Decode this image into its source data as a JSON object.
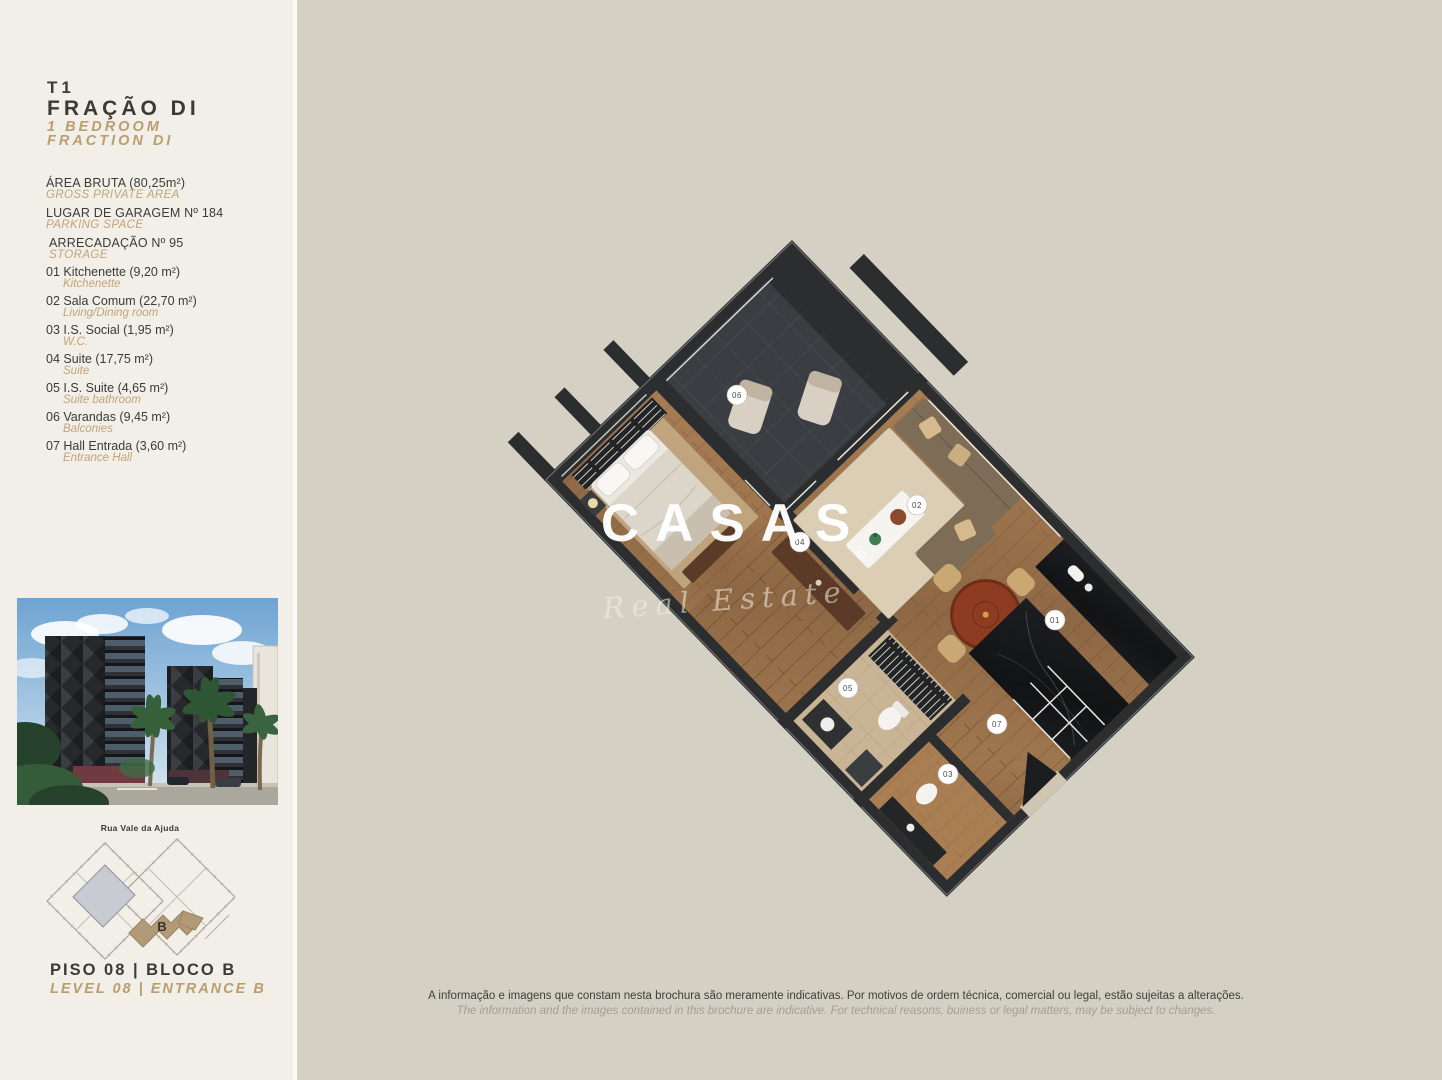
{
  "colors": {
    "sidebar_bg": "#f1efe8",
    "main_bg": "#d4d0c3",
    "accent_tan": "#bb9e6f",
    "text_dark": "#3b3a37",
    "wall_dark": "#2c2d2f"
  },
  "sidebar": {
    "unit_type": "T1",
    "unit_name_pt": "FRAÇÃO DI",
    "unit_name_en_line1": "1 BEDROOM",
    "unit_name_en_line2": "FRACTION DI",
    "specs": [
      {
        "pt": "ÁREA BRUTA (80,25m²)",
        "en": "GROSS PRIVATE AREA"
      },
      {
        "pt": "LUGAR DE GARAGEM Nº 184",
        "en": "PARKING SPACE"
      },
      {
        "pt": "ARRECADAÇÃO Nº 95",
        "en": "STORAGE"
      }
    ],
    "rooms": [
      {
        "pt": "01 Kitchenette (9,20 m²)",
        "en": "Kitchenette"
      },
      {
        "pt": "02 Sala Comum (22,70 m²)",
        "en": "Living/Dining room"
      },
      {
        "pt": "03 I.S. Social (1,95 m²)",
        "en": "W.C."
      },
      {
        "pt": "04 Suite (17,75 m²)",
        "en": "Suite"
      },
      {
        "pt": "05 I.S. Suite (4,65 m²)",
        "en": "Suite bathroom"
      },
      {
        "pt": "06 Varandas (9,45 m²)",
        "en": "Balconies"
      },
      {
        "pt": "07 Hall Entrada (3,60 m²)",
        "en": "Entrance Hall"
      }
    ],
    "site": {
      "street": "Rua Vale da Ajuda",
      "block": "B"
    },
    "footer": {
      "pt": "PISO 08 | BLOCO B",
      "en": "LEVEL 08 | ENTRANCE B"
    }
  },
  "floorplan": {
    "watermark": {
      "brand": "CASAS",
      "registered": "®",
      "tagline": "Real Estate"
    },
    "labels": [
      {
        "num": "01"
      },
      {
        "num": "02"
      },
      {
        "num": "03"
      },
      {
        "num": "04"
      },
      {
        "num": "05"
      },
      {
        "num": "06"
      },
      {
        "num": "07"
      }
    ]
  },
  "disclaimer": {
    "pt": "A informação e imagens que constam nesta brochura são meramente indicativas. Por motivos de ordem técnica, comercial ou legal, estão sujeitas a alterações.",
    "en": "The information and the images contained in this brochure are indicative. For technical reasons, buiness or legal matters, may be subject to changes."
  }
}
